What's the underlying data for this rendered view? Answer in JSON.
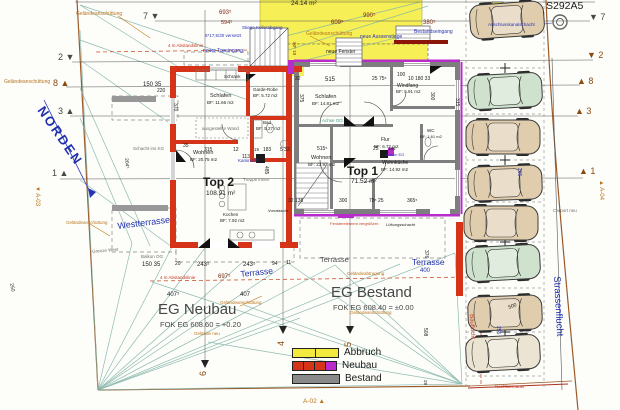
{
  "colors": {
    "k": "#1b1b1b",
    "b": "#2a35b4",
    "bl": "#1f2fae",
    "o": "#b9741d",
    "o2": "#8a4a10",
    "r": "#c23a22",
    "g": "#6e6e6e",
    "t": "#3f9a85",
    "m": "#7c2a10",
    "d": "#474747",
    "wall_new": "#d63418",
    "wall_old": "#7e7e7e",
    "demolition": "#f6ef55",
    "marker_purple": "#b82ccc",
    "survey": "#82b4a9",
    "boundary": "#9a5a28"
  },
  "legend": {
    "items": [
      {
        "label": "Abbruch",
        "swatches": [
          "#f2ea3e",
          "#f2ea3e"
        ]
      },
      {
        "label": "Neubau",
        "swatches": [
          "#d63418",
          "#d63418",
          "#d63418",
          "#b82ccc"
        ]
      },
      {
        "label": "Bestand",
        "swatches": [
          "#8a8a8a"
        ]
      }
    ]
  },
  "cars": [
    {
      "x": 470,
      "y": 3,
      "c": "tan",
      "r": -4
    },
    {
      "x": 468,
      "y": 74,
      "c": "green",
      "r": -3
    },
    {
      "x": 466,
      "y": 120,
      "c": "tan",
      "r": 0
    },
    {
      "x": 468,
      "y": 166,
      "c": "tan",
      "r": -2
    },
    {
      "x": 464,
      "y": 206,
      "c": "tan",
      "r": 0
    },
    {
      "x": 466,
      "y": 246,
      "c": "green",
      "r": -3
    },
    {
      "x": 468,
      "y": 296,
      "c": "tan",
      "r": -2
    },
    {
      "x": 466,
      "y": 336,
      "c": "cream",
      "r": -3
    }
  ],
  "car_colors": {
    "tan": "#dfcdae",
    "green": "#cfe2cd",
    "cream": "#ece4d2"
  },
  "labels": [
    {
      "n": "sheet-code",
      "t": "S292A5",
      "x": 546,
      "y": 1,
      "s": 10.5,
      "c": "k"
    },
    {
      "n": "north-label",
      "t": "NORDEN",
      "x": 46,
      "y": 104,
      "s": 13,
      "c": "bl",
      "r": 55,
      "b": 1,
      "ls": 2
    },
    {
      "n": "dim-area-24-14",
      "t": "24.14 m²",
      "x": 291,
      "y": 1,
      "s": 6.5,
      "c": "k"
    },
    {
      "n": "lbl-gelaendeanschuettung-1",
      "t": "Geländeanschüttung",
      "x": 76,
      "y": 12,
      "s": 5,
      "c": "o"
    },
    {
      "n": "dim-693",
      "t": "693⁵",
      "x": 219,
      "y": 10,
      "s": 6,
      "c": "m"
    },
    {
      "n": "dim-594",
      "t": "594⁵",
      "x": 221,
      "y": 21,
      "s": 5.5,
      "c": "m"
    },
    {
      "n": "dim-990",
      "t": "990⁵",
      "x": 363,
      "y": 13,
      "s": 6,
      "c": "m"
    },
    {
      "n": "dim-609",
      "t": "609⁵",
      "x": 331,
      "y": 20,
      "s": 6,
      "c": "m"
    },
    {
      "n": "dim-380",
      "t": "380⁵",
      "x": 423,
      "y": 20,
      "s": 6,
      "c": "m"
    },
    {
      "n": "lbl-stiege-kellerabgang",
      "t": "Stiege Kellerabgang",
      "x": 242,
      "y": 26,
      "s": 4.5,
      "c": "b"
    },
    {
      "n": "lbl-versetzt",
      "t": "6*17,5/30 versetzt",
      "x": 205,
      "y": 34,
      "s": 4.5,
      "c": "b"
    },
    {
      "n": "lbl-gelaendeanschuettung-2",
      "t": "Geländeanschüttung",
      "x": 306,
      "y": 32,
      "s": 5,
      "c": "o"
    },
    {
      "n": "lbl-neue-aussenstiege",
      "t": "neue Aussenstiege",
      "x": 360,
      "y": 35,
      "s": 5,
      "c": "b"
    },
    {
      "n": "lbl-bestandseingang",
      "t": "Bestandseingang",
      "x": 414,
      "y": 30,
      "s": 5,
      "c": "b"
    },
    {
      "n": "lbl-anschlusskanalschacht",
      "t": "Anschlusskanalschacht",
      "x": 488,
      "y": 23,
      "s": 4.5,
      "c": "b"
    },
    {
      "n": "lbl-neuer-topeingang",
      "t": "neuer Topeingang",
      "x": 203,
      "y": 49,
      "s": 5,
      "c": "b"
    },
    {
      "n": "lbl-neue-fenster",
      "t": "neue Fenster",
      "x": 326,
      "y": 50,
      "s": 5,
      "c": "k"
    },
    {
      "n": "lbl-abstandslinie-1",
      "t": "4 m Abstandslinie",
      "x": 168,
      "y": 44,
      "s": 4.5,
      "c": "r"
    },
    {
      "n": "lbl-gelaendeanschuettung-3",
      "t": "Geländeanschüttung",
      "x": 4,
      "y": 80,
      "s": 5,
      "c": "o"
    },
    {
      "n": "dim-90-10",
      "t": "90⁵ 10",
      "x": 296,
      "y": 42,
      "s": 4.5,
      "c": "m",
      "r": 90
    },
    {
      "n": "dim-150-35-top",
      "t": "150  35",
      "x": 143,
      "y": 82,
      "s": 6,
      "c": "k"
    },
    {
      "n": "dim-220",
      "t": "220",
      "x": 157,
      "y": 89,
      "s": 5,
      "c": "k"
    },
    {
      "n": "dim-32",
      "t": "32",
      "x": 295,
      "y": 77,
      "s": 5,
      "c": "k"
    },
    {
      "n": "dim-515-top",
      "t": "515",
      "x": 325,
      "y": 77,
      "s": 6,
      "c": "k"
    },
    {
      "n": "dim-25-75",
      "t": "25  75⁵",
      "x": 372,
      "y": 77,
      "s": 5,
      "c": "k"
    },
    {
      "n": "dim-100",
      "t": "100",
      "x": 397,
      "y": 73,
      "s": 5,
      "c": "k"
    },
    {
      "n": "dim-10-180-33",
      "t": "10  180  33",
      "x": 408,
      "y": 77,
      "s": 5,
      "c": "k"
    },
    {
      "n": "dim-370",
      "t": "370",
      "x": 177,
      "y": 103,
      "s": 5,
      "c": "k",
      "r": 90
    },
    {
      "n": "dim-375",
      "t": "375",
      "x": 303,
      "y": 94,
      "s": 5,
      "c": "k",
      "r": 90
    },
    {
      "n": "dim-300-wall",
      "t": "300",
      "x": 434,
      "y": 92,
      "s": 5,
      "c": "k",
      "r": 90
    },
    {
      "n": "dim-315-wall",
      "t": "315",
      "x": 459,
      "y": 98,
      "s": 5,
      "c": "k",
      "r": 90
    },
    {
      "n": "room-schlafen-top2",
      "t": "Schlafen",
      "x": 210,
      "y": 94,
      "s": 5.5,
      "c": "k"
    },
    {
      "n": "room-schlafen-top2-area",
      "t": "BF: 11.66 m2",
      "x": 207,
      "y": 101,
      "s": 4.5,
      "c": "k"
    },
    {
      "n": "room-schrank",
      "t": "Schrank",
      "x": 224,
      "y": 75,
      "s": 4.5,
      "c": "k"
    },
    {
      "n": "room-garderobe",
      "t": "Garde-Robe",
      "x": 253,
      "y": 88,
      "s": 4.5,
      "c": "k"
    },
    {
      "n": "room-garderobe-area",
      "t": "BF: 5.72 m2",
      "x": 253,
      "y": 94,
      "s": 4.5,
      "c": "k"
    },
    {
      "n": "room-schlafen-top1",
      "t": "Schlafen",
      "x": 315,
      "y": 95,
      "s": 5.5,
      "c": "k"
    },
    {
      "n": "room-schlafen-top1-area",
      "t": "BF: 14.81 m2",
      "x": 312,
      "y": 102,
      "s": 4.5,
      "c": "k"
    },
    {
      "n": "lbl-achse-og",
      "t": "Achse OG",
      "x": 322,
      "y": 119,
      "s": 4.5,
      "c": "t"
    },
    {
      "n": "room-windfang",
      "t": "Windfang",
      "x": 397,
      "y": 84,
      "s": 5,
      "c": "k"
    },
    {
      "n": "room-windfang-area",
      "t": "BF: 5.91 m2",
      "x": 396,
      "y": 90,
      "s": 4.5,
      "c": "k"
    },
    {
      "n": "room-bad",
      "t": "Bad",
      "x": 263,
      "y": 121,
      "s": 4.5,
      "c": "k"
    },
    {
      "n": "room-bad-area",
      "t": "BF: 5.27 m2",
      "x": 256,
      "y": 127,
      "s": 4.5,
      "c": "k"
    },
    {
      "n": "lbl-ausgestellte-wand",
      "t": "ausgestellte Wand",
      "x": 202,
      "y": 127,
      "s": 4.5,
      "c": "g"
    },
    {
      "n": "lbl-schacht-ins-kg",
      "t": "Schacht ins KG",
      "x": 133,
      "y": 147,
      "s": 4.5,
      "c": "g"
    },
    {
      "n": "dim-204",
      "t": "204⁵",
      "x": 128,
      "y": 158,
      "s": 5,
      "c": "k",
      "r": 85
    },
    {
      "n": "room-flur",
      "t": "Flur",
      "x": 381,
      "y": 138,
      "s": 5,
      "c": "k"
    },
    {
      "n": "room-flur-area",
      "t": "BF: 6.72 m2",
      "x": 374,
      "y": 145,
      "s": 4.5,
      "c": "k"
    },
    {
      "n": "room-wc",
      "t": "WC",
      "x": 427,
      "y": 129,
      "s": 4.5,
      "c": "k"
    },
    {
      "n": "room-wc-area",
      "t": "BF: 1.61 m2",
      "x": 420,
      "y": 135,
      "s": 4,
      "c": "k"
    },
    {
      "n": "dim-35-mid",
      "t": "35",
      "x": 183,
      "y": 144,
      "s": 5,
      "c": "k"
    },
    {
      "n": "dim-315-mid",
      "t": "315",
      "x": 204,
      "y": 148,
      "s": 5,
      "c": "k"
    },
    {
      "n": "dim-12-mid",
      "t": "12",
      "x": 233,
      "y": 148,
      "s": 5,
      "c": "k"
    },
    {
      "n": "dim-113",
      "t": "113",
      "x": 242,
      "y": 155,
      "s": 5,
      "c": "k"
    },
    {
      "n": "dim-19",
      "t": "19",
      "x": 254,
      "y": 148,
      "s": 4.5,
      "c": "k"
    },
    {
      "n": "dim-183",
      "t": "183",
      "x": 263,
      "y": 148,
      "s": 5,
      "c": "k"
    },
    {
      "n": "dim-5-33",
      "t": "5   33",
      "x": 280,
      "y": 148,
      "s": 5,
      "c": "k"
    },
    {
      "n": "dim-515-mid",
      "t": "515⁵",
      "x": 317,
      "y": 147,
      "s": 5,
      "c": "k"
    },
    {
      "n": "dim-25-mid",
      "t": "25",
      "x": 373,
      "y": 147,
      "s": 5,
      "c": "k"
    },
    {
      "n": "dim-185",
      "t": "185",
      "x": 388,
      "y": 147,
      "s": 4.5,
      "c": "k"
    },
    {
      "n": "room-wohnen-top2",
      "t": "Wohnen",
      "x": 193,
      "y": 151,
      "s": 5.5,
      "c": "k"
    },
    {
      "n": "room-wohnen-top2-area",
      "t": "BF: 20.75 m2",
      "x": 190,
      "y": 158,
      "s": 4.5,
      "c": "k"
    },
    {
      "n": "lbl-kamin-eg-top2",
      "t": "Kamin EG",
      "x": 238,
      "y": 159,
      "s": 4.5,
      "c": "b"
    },
    {
      "n": "room-wohnen-top1",
      "t": "Wohnen",
      "x": 311,
      "y": 156,
      "s": 5.5,
      "c": "k"
    },
    {
      "n": "room-wohnen-top1-area",
      "t": "BF: 23.92 m2",
      "x": 308,
      "y": 163,
      "s": 4.5,
      "c": "k"
    },
    {
      "n": "lbl-kamin-eg-top1",
      "t": "Kamin EG",
      "x": 386,
      "y": 153,
      "s": 4,
      "c": "b"
    },
    {
      "n": "room-wohnkueche",
      "t": "Wohnküche",
      "x": 382,
      "y": 161,
      "s": 5,
      "c": "k"
    },
    {
      "n": "room-wohnkueche-area",
      "t": "BF: 14.92 m2",
      "x": 381,
      "y": 168,
      "s": 4.5,
      "c": "k"
    },
    {
      "n": "unit-top2",
      "t": "Top 2",
      "x": 203,
      "y": 176,
      "s": 12,
      "c": "k",
      "b": 1
    },
    {
      "n": "unit-top2-area",
      "t": "108.91 m²",
      "x": 206,
      "y": 191,
      "s": 6.5,
      "c": "k"
    },
    {
      "n": "unit-top1",
      "t": "Top 1",
      "x": 347,
      "y": 165,
      "s": 12,
      "c": "k",
      "b": 1
    },
    {
      "n": "unit-top1-area",
      "t": "71.52 m²",
      "x": 351,
      "y": 179,
      "s": 6.5,
      "c": "k"
    },
    {
      "n": "lbl-treppe-innen",
      "t": "Treppe innen",
      "x": 243,
      "y": 178,
      "s": 4.5,
      "c": "g"
    },
    {
      "n": "dim-485",
      "t": "485",
      "x": 268,
      "y": 166,
      "s": 5,
      "c": "k",
      "r": 90
    },
    {
      "n": "dim-265-parking",
      "t": "265",
      "x": 521,
      "y": 168,
      "s": 5,
      "c": "b",
      "r": 90
    },
    {
      "n": "room-kochen",
      "t": "Kochen",
      "x": 223,
      "y": 213,
      "s": 4.5,
      "c": "k"
    },
    {
      "n": "room-kochen-area",
      "t": "BF: 7.92 m2",
      "x": 220,
      "y": 219,
      "s": 4.5,
      "c": "k"
    },
    {
      "n": "lbl-vorratsschrank",
      "t": "Vorratsschr.",
      "x": 268,
      "y": 209,
      "s": 4,
      "c": "k"
    },
    {
      "n": "dim-32-138",
      "t": "32  138",
      "x": 288,
      "y": 199,
      "s": 5,
      "c": "k"
    },
    {
      "n": "dim-300-bot",
      "t": "300",
      "x": 339,
      "y": 199,
      "s": 5,
      "c": "k"
    },
    {
      "n": "dim-78-25",
      "t": "78⁵  25",
      "x": 369,
      "y": 199,
      "s": 5,
      "c": "k"
    },
    {
      "n": "dim-365",
      "t": "365⁵",
      "x": 407,
      "y": 199,
      "s": 5,
      "c": "k"
    },
    {
      "n": "lbl-fensterelement",
      "t": "Fensterelement vergrößern",
      "x": 330,
      "y": 222,
      "s": 4,
      "c": "r"
    },
    {
      "n": "lbl-lueftungsschacht",
      "t": "Lüftungsschacht",
      "x": 386,
      "y": 223,
      "s": 4,
      "c": "k"
    },
    {
      "n": "lbl-westterrasse",
      "t": "Westterrasse",
      "x": 117,
      "y": 222,
      "s": 9,
      "c": "bl",
      "r": -7
    },
    {
      "n": "lbl-balkon-og",
      "t": "Balkon OG",
      "x": 141,
      "y": 255,
      "s": 4.5,
      "c": "g"
    },
    {
      "n": "lbl-grenze-west",
      "t": "Grenze West",
      "x": 92,
      "y": 250,
      "s": 4.5,
      "c": "g",
      "r": -5
    },
    {
      "n": "lbl-gelaendeanschuettung-4",
      "t": "Geländeanschüttung",
      "x": 66,
      "y": 221,
      "s": 4.5,
      "c": "o"
    },
    {
      "n": "dim-150-35-bot",
      "t": "150  35",
      "x": 142,
      "y": 262,
      "s": 6,
      "c": "k"
    },
    {
      "n": "dim-20-bot",
      "t": "20",
      "x": 175,
      "y": 262,
      "s": 5,
      "c": "k"
    },
    {
      "n": "dim-243-1",
      "t": "243⁵",
      "x": 197,
      "y": 262,
      "s": 6,
      "c": "k"
    },
    {
      "n": "dim-243-2",
      "t": "243⁵",
      "x": 243,
      "y": 262,
      "s": 6,
      "c": "k"
    },
    {
      "n": "dim-94",
      "t": "94",
      "x": 272,
      "y": 262,
      "s": 5,
      "c": "k"
    },
    {
      "n": "dim-11",
      "t": "11",
      "x": 286,
      "y": 261,
      "s": 5,
      "c": "k"
    },
    {
      "n": "lbl-terrasse-west",
      "t": "Terrasse",
      "x": 240,
      "y": 270,
      "s": 8.5,
      "c": "bl",
      "r": -6
    },
    {
      "n": "dim-697",
      "t": "697⁵",
      "x": 218,
      "y": 274,
      "s": 6,
      "c": "m"
    },
    {
      "n": "lbl-terrasse-mitte",
      "t": "Terrasse",
      "x": 320,
      "y": 256,
      "s": 7.5,
      "c": "d"
    },
    {
      "n": "lbl-terrasse-ost",
      "t": "Terrasse",
      "x": 412,
      "y": 258,
      "s": 8.5,
      "c": "bl"
    },
    {
      "n": "dim-400",
      "t": "400",
      "x": 420,
      "y": 268,
      "s": 6,
      "c": "bl"
    },
    {
      "n": "dim-376",
      "t": "376",
      "x": 428,
      "y": 250,
      "s": 5,
      "c": "k",
      "r": 90
    },
    {
      "n": "lbl-abstandslinie-2",
      "t": "4 m Abstandslinie",
      "x": 160,
      "y": 276,
      "s": 4.5,
      "c": "r"
    },
    {
      "n": "dim-407-1",
      "t": "407⁵",
      "x": 167,
      "y": 292,
      "s": 6,
      "c": "k"
    },
    {
      "n": "dim-407-2",
      "t": "407",
      "x": 240,
      "y": 292,
      "s": 6,
      "c": "k"
    },
    {
      "n": "lbl-gelaendeanschuettung-5",
      "t": "Geländeanschüttung",
      "x": 220,
      "y": 301,
      "s": 4.5,
      "c": "o"
    },
    {
      "n": "lbl-gelaendeabtragung",
      "t": "Geländeabtragung",
      "x": 347,
      "y": 272,
      "s": 4.5,
      "c": "o"
    },
    {
      "n": "title-eg-neubau",
      "t": "EG Neubau",
      "x": 158,
      "y": 302,
      "s": 15,
      "c": "d"
    },
    {
      "n": "title-eg-neubau-fok",
      "t": "FOK EG 608.60 = +0.20",
      "x": 160,
      "y": 321,
      "s": 7.5,
      "c": "d"
    },
    {
      "n": "title-eg-bestand",
      "t": "EG Bestand",
      "x": 331,
      "y": 285,
      "s": 15,
      "c": "d"
    },
    {
      "n": "title-eg-bestand-fok",
      "t": "FOK EG 608.40 = ±0.00",
      "x": 333,
      "y": 304,
      "s": 7.5,
      "c": "d"
    },
    {
      "n": "lbl-gelaendeanschuettung-6",
      "t": "Geländeanschüttung",
      "x": 350,
      "y": 311,
      "s": 4.5,
      "c": "o"
    },
    {
      "n": "lbl-gelaende-neu",
      "t": "Gelände neu",
      "x": 194,
      "y": 332,
      "s": 4.5,
      "c": "o"
    },
    {
      "n": "dim-508",
      "t": "508",
      "x": 427,
      "y": 328,
      "s": 5,
      "c": "k",
      "r": 90
    },
    {
      "n": "dim-250",
      "t": "250",
      "x": 13,
      "y": 283,
      "s": 5,
      "c": "k",
      "r": 78
    },
    {
      "n": "lbl-strassenflucht",
      "t": "Strassenflucht",
      "x": 561,
      "y": 276,
      "s": 9.5,
      "c": "bl",
      "r": 87
    },
    {
      "n": "lbl-bauflucht",
      "t": "Bauflucht",
      "x": 474,
      "y": 314,
      "s": 6,
      "c": "r",
      "r": 87
    },
    {
      "n": "lbl-carport-neu",
      "t": "Carport neu",
      "x": 553,
      "y": 209,
      "s": 4.5,
      "c": "g"
    },
    {
      "n": "lbl-nachbarmauer",
      "t": "Nachbarmauer",
      "x": 495,
      "y": 385,
      "s": 4.5,
      "c": "r"
    },
    {
      "n": "dim-500",
      "t": "500",
      "x": 508,
      "y": 306,
      "s": 5,
      "c": "k",
      "r": -20
    },
    {
      "n": "dim-255",
      "t": "255",
      "x": 500,
      "y": 326,
      "s": 5,
      "c": "b",
      "r": 90
    },
    {
      "n": "dim-28",
      "t": "28",
      "x": 427,
      "y": 380,
      "s": 4.5,
      "c": "k",
      "r": 90
    },
    {
      "n": "axis-left-7",
      "t": "7 ▼",
      "x": 143,
      "y": 12,
      "s": 9,
      "c": "d"
    },
    {
      "n": "axis-left-2",
      "t": "2 ▼",
      "x": 58,
      "y": 53,
      "s": 9,
      "c": "d"
    },
    {
      "n": "axis-left-8",
      "t": "8 ▲",
      "x": 53,
      "y": 79,
      "s": 9,
      "c": "o2"
    },
    {
      "n": "axis-left-3",
      "t": "3 ▲",
      "x": 58,
      "y": 107,
      "s": 9,
      "c": "d"
    },
    {
      "n": "axis-left-1",
      "t": "1 ▲",
      "x": 52,
      "y": 169,
      "s": 9,
      "c": "d"
    },
    {
      "n": "axis-right-7",
      "t": "▼ 7",
      "x": 589,
      "y": 13,
      "s": 9,
      "c": "d"
    },
    {
      "n": "axis-right-2",
      "t": "▼ 2",
      "x": 587,
      "y": 51,
      "s": 9,
      "c": "o2"
    },
    {
      "n": "axis-right-8",
      "t": "▲ 8",
      "x": 577,
      "y": 77,
      "s": 9,
      "c": "o2"
    },
    {
      "n": "axis-right-3",
      "t": "▲ 3",
      "x": 575,
      "y": 107,
      "s": 9,
      "c": "o2"
    },
    {
      "n": "axis-right-1",
      "t": "▲ 1",
      "x": 579,
      "y": 167,
      "s": 9,
      "c": "o2"
    },
    {
      "n": "axis-bottom-6",
      "t": "6",
      "x": 199,
      "y": 376,
      "s": 9,
      "c": "o2",
      "r": -90
    },
    {
      "n": "axis-bottom-4",
      "t": "4",
      "x": 277,
      "y": 346,
      "s": 9,
      "c": "o2",
      "r": -90
    },
    {
      "n": "axis-bottom-5",
      "t": "5",
      "x": 344,
      "y": 347,
      "s": 9,
      "c": "o2",
      "r": -90
    },
    {
      "n": "section-ref-a03",
      "t": "▼ A-03",
      "x": 40,
      "y": 186,
      "s": 6,
      "c": "o",
      "r": 90
    },
    {
      "n": "section-ref-a02",
      "t": "A-02 ▲",
      "x": 303,
      "y": 399,
      "s": 6.5,
      "c": "o"
    },
    {
      "n": "section-ref-a04",
      "t": "▲ A-04",
      "x": 604,
      "y": 180,
      "s": 6,
      "c": "o",
      "r": 90
    }
  ]
}
